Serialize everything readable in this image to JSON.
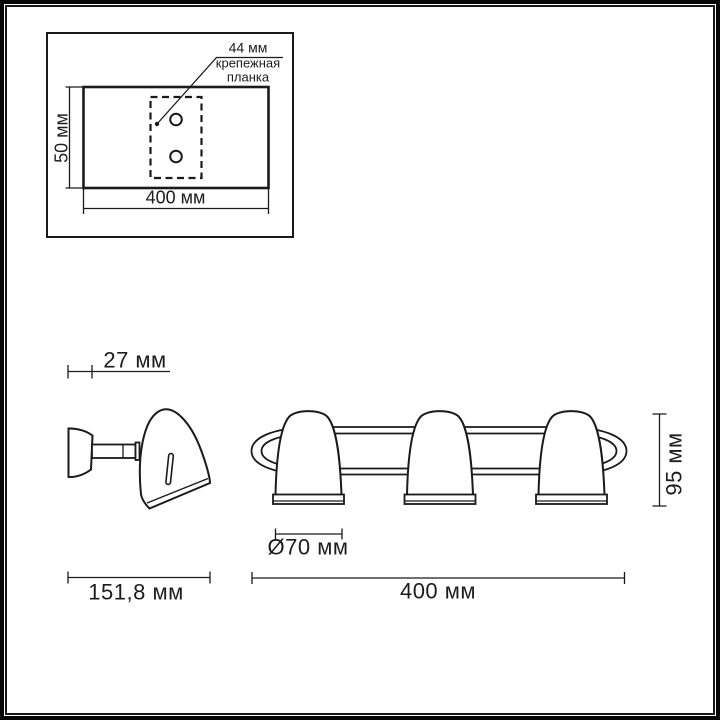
{
  "colors": {
    "ink": "#1a1a1a",
    "background": "#ffffff"
  },
  "mounting_template": {
    "hole_spacing_label": "44 мм",
    "bracket_label": {
      "line1": "крепежная",
      "line2": "планка"
    },
    "height_label": "50 мм",
    "width_label": "400 мм"
  },
  "side_view": {
    "bracket_depth_label": "27 мм",
    "overall_depth_label": "151,8 мм"
  },
  "front_view": {
    "shade_diameter_label": "Ø70 мм",
    "height_label": "95 мм",
    "overall_width_label": "400 мм"
  }
}
